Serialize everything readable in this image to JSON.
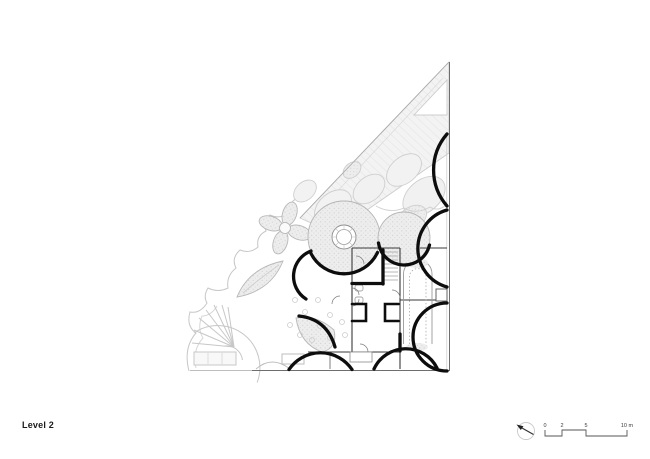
{
  "drawing": {
    "title": "Level 2"
  },
  "scale_bar": {
    "labels": [
      "0",
      "2",
      "5",
      "10 m"
    ]
  },
  "north_arrow": {
    "icon": "north-arrow-icon"
  },
  "colors": {
    "paper": "#ffffff",
    "heavy_wall": "#0d0d0d",
    "thin_wall": "#555555",
    "context_line": "#c9c9c9",
    "light_fill": "#f2f2f2",
    "stipple_dot": "#d3d3d3",
    "text": "#1a1a1a"
  }
}
